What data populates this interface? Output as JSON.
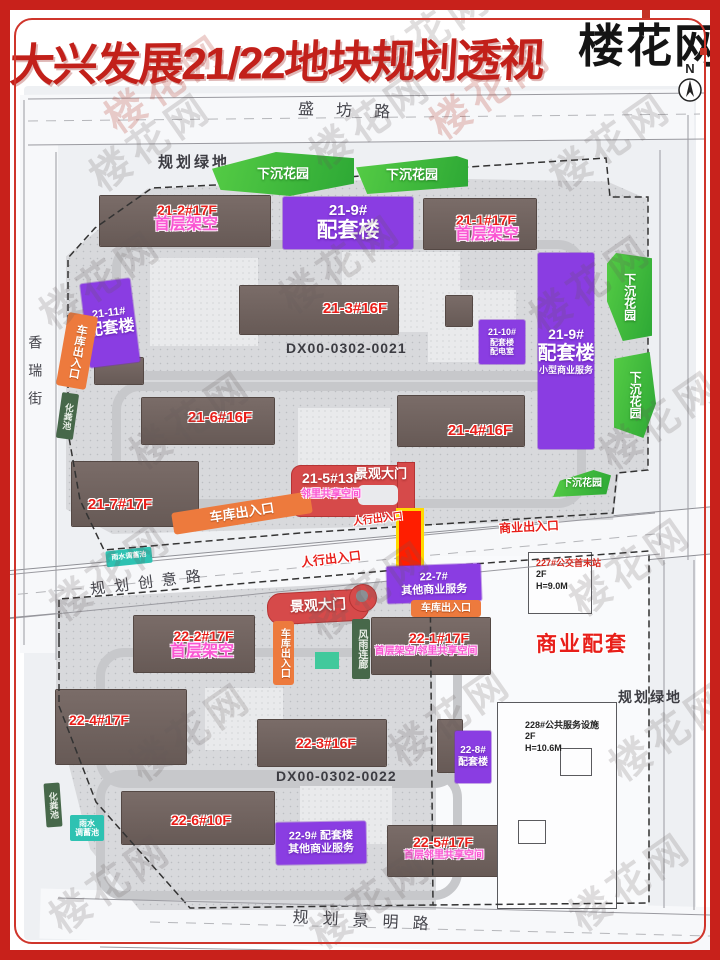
{
  "header": {
    "title": "大兴发展21/22地块规划透视",
    "logo": "楼花网",
    "compass": "N"
  },
  "watermark": {
    "text": "楼花网"
  },
  "map": {
    "parcel_codes": [
      "DX00-0302-0021",
      "DX00-0302-0022"
    ],
    "labels": [
      {
        "name": "road-shengfang",
        "type": "road-text",
        "x": 285,
        "y": 103,
        "w": 140,
        "rot": 2,
        "ls": 22,
        "lines": [
          {
            "t": "盛坊路",
            "fs": 16
          }
        ]
      },
      {
        "name": "road-xiangrui",
        "type": "road-text",
        "x": 26,
        "y": 332,
        "w": 18,
        "h": 90,
        "vert": true,
        "ls": 14,
        "lines": [
          {
            "t": "香瑞街",
            "fs": 14
          }
        ]
      },
      {
        "name": "road-chuangyi",
        "type": "road-text",
        "x": 90,
        "y": 574,
        "w": 120,
        "rot": -7,
        "ls": 9,
        "lines": [
          {
            "t": "规划创意路",
            "fs": 15
          }
        ]
      },
      {
        "name": "road-jingming",
        "type": "road-text",
        "x": 280,
        "y": 913,
        "w": 175,
        "rot": 3,
        "ls": 14,
        "lines": [
          {
            "t": "规划景明路",
            "fs": 16
          }
        ]
      },
      {
        "name": "green-space-top",
        "type": "black-text",
        "x": 158,
        "y": 154,
        "ls": 3,
        "lines": [
          {
            "t": "规划绿地",
            "fs": 15
          }
        ]
      },
      {
        "name": "green-space-right",
        "type": "black-text",
        "x": 618,
        "y": 689,
        "ls": 2,
        "lines": [
          {
            "t": "规划绿地",
            "fs": 14
          }
        ]
      },
      {
        "name": "parcel-code-21",
        "type": "black-text",
        "x": 286,
        "y": 340,
        "ls": 1,
        "lines": [
          {
            "t": "DX00-0302-0021",
            "fs": 14
          }
        ]
      },
      {
        "name": "parcel-code-22",
        "type": "black-text",
        "x": 276,
        "y": 768,
        "ls": 1,
        "lines": [
          {
            "t": "DX00-0302-0022",
            "fs": 14
          }
        ]
      },
      {
        "name": "bus-terminal-note",
        "type": "note-text",
        "x": 536,
        "y": 558,
        "w": 72,
        "lines": [
          {
            "t": "227#公交首末站",
            "fs": 9,
            "cls": "red-line"
          },
          {
            "t": "2F",
            "fs": 9
          },
          {
            "t": "H=9.0M",
            "fs": 9
          }
        ]
      },
      {
        "name": "public-service-note",
        "type": "note-text",
        "x": 525,
        "y": 720,
        "w": 80,
        "lines": [
          {
            "t": "228#公共服务设施",
            "fs": 9
          },
          {
            "t": "2F",
            "fs": 9
          },
          {
            "t": "H=10.6M",
            "fs": 9
          }
        ]
      },
      {
        "name": "garden-1",
        "type": "green-box",
        "x": 212,
        "y": 152,
        "w": 142,
        "h": 44,
        "clip": "0% 38%, 45% 0%, 100% 14%, 100% 72%, 55% 100%, 6% 86%",
        "lines": [
          {
            "t": "下沉花园",
            "fs": 13
          }
        ]
      },
      {
        "name": "garden-2",
        "type": "green-box",
        "x": 356,
        "y": 156,
        "w": 112,
        "h": 38,
        "clip": "0% 30%, 90% 0%, 100% 10%, 100% 80%, 10% 100%",
        "lines": [
          {
            "t": "下沉花园",
            "fs": 13
          }
        ]
      },
      {
        "name": "garden-3",
        "type": "green-box",
        "x": 607,
        "y": 253,
        "w": 45,
        "h": 88,
        "vert": true,
        "clip": "20% 0%, 100% 6%, 100% 94%, 35% 100%, 0% 55%, 0% 12%",
        "lines": [
          {
            "t": "下沉花园",
            "fs": 12
          }
        ]
      },
      {
        "name": "garden-4",
        "type": "green-box",
        "x": 614,
        "y": 352,
        "w": 42,
        "h": 86,
        "vert": true,
        "clip": "0% 8%, 85% 0%, 100% 60%, 70% 100%, 0% 88%",
        "lines": [
          {
            "t": "下沉花园",
            "fs": 12
          }
        ]
      },
      {
        "name": "garden-5",
        "type": "green-box",
        "x": 553,
        "y": 470,
        "w": 58,
        "h": 27,
        "clip": "12% 40%, 70% 0%, 100% 20%, 92% 90%, 0% 100%",
        "lines": [
          {
            "t": "下沉花园",
            "fs": 10
          }
        ]
      },
      {
        "name": "box-21-9-top",
        "type": "purple-box",
        "x": 283,
        "y": 197,
        "w": 130,
        "h": 52,
        "lines": [
          {
            "t": "21-9#",
            "fs": 15
          },
          {
            "t": "配套楼",
            "fs": 21
          }
        ]
      },
      {
        "name": "box-21-9-right",
        "type": "purple-box",
        "x": 538,
        "y": 253,
        "w": 56,
        "h": 196,
        "lines": [
          {
            "t": "21-9#",
            "fs": 14
          },
          {
            "t": "配套楼",
            "fs": 19
          },
          {
            "t": "小型商业服务",
            "fs": 9
          }
        ]
      },
      {
        "name": "box-21-11",
        "type": "purple-box",
        "x": 85,
        "y": 281,
        "w": 50,
        "h": 84,
        "rot": -7,
        "lines": [
          {
            "t": "21-11#",
            "fs": 11
          },
          {
            "t": "配套楼",
            "fs": 16
          }
        ]
      },
      {
        "name": "box-21-10",
        "type": "purple-box",
        "x": 479,
        "y": 320,
        "w": 46,
        "h": 44,
        "lines": [
          {
            "t": "21-10#",
            "fs": 9
          },
          {
            "t": "配套楼",
            "fs": 8
          },
          {
            "t": "配电室",
            "fs": 8
          }
        ]
      },
      {
        "name": "box-22-7",
        "type": "purple-box",
        "x": 387,
        "y": 565,
        "w": 94,
        "h": 37,
        "rot": -2,
        "lines": [
          {
            "t": "22-7#",
            "fs": 11
          },
          {
            "t": "其他商业服务",
            "fs": 11
          }
        ]
      },
      {
        "name": "box-22-8",
        "type": "purple-box",
        "x": 455,
        "y": 731,
        "w": 36,
        "h": 52,
        "lines": [
          {
            "t": "22-8#",
            "fs": 10
          },
          {
            "t": "配套楼",
            "fs": 10
          }
        ]
      },
      {
        "name": "box-22-9",
        "type": "purple-box",
        "x": 276,
        "y": 822,
        "w": 90,
        "h": 42,
        "rot": -1,
        "lines": [
          {
            "t": "22-9# 配套楼",
            "fs": 11
          },
          {
            "t": "其他商业服务",
            "fs": 11
          }
        ]
      },
      {
        "name": "garage-entrance-left",
        "type": "orange-box",
        "x": 62,
        "y": 314,
        "w": 30,
        "h": 74,
        "rot": 10,
        "vert": true,
        "lines": [
          {
            "t": "车库出入口",
            "fs": 11
          }
        ]
      },
      {
        "name": "garage-entrance-mid",
        "type": "orange-box",
        "x": 172,
        "y": 502,
        "w": 140,
        "h": 22,
        "rot": -9,
        "lines": [
          {
            "t": "车库出入口",
            "fs": 13
          }
        ]
      },
      {
        "name": "garage-entrance-22-right",
        "type": "orange-box",
        "x": 411,
        "y": 600,
        "w": 70,
        "h": 17,
        "lines": [
          {
            "t": "车库出入口",
            "fs": 10
          }
        ]
      },
      {
        "name": "garage-entrance-22-vert",
        "type": "orange-box",
        "x": 273,
        "y": 621,
        "w": 21,
        "h": 64,
        "vert": true,
        "lines": [
          {
            "t": "车库出入口",
            "fs": 10
          }
        ]
      },
      {
        "name": "septic-tank-upper",
        "type": "darkgreen-box",
        "x": 59,
        "y": 393,
        "w": 17,
        "h": 46,
        "vert": true,
        "rot": 8,
        "lines": [
          {
            "t": "化粪池",
            "fs": 9
          }
        ]
      },
      {
        "name": "septic-tank-lower",
        "type": "darkgreen-box",
        "x": 45,
        "y": 783,
        "w": 16,
        "h": 44,
        "vert": true,
        "rot": -4,
        "lines": [
          {
            "t": "化粪池",
            "fs": 9
          }
        ]
      },
      {
        "name": "rain-corridor",
        "type": "darkgreen-box",
        "x": 352,
        "y": 619,
        "w": 18,
        "h": 60,
        "vert": true,
        "lines": [
          {
            "t": "风雨连廊",
            "fs": 10
          }
        ]
      },
      {
        "name": "rain-pool-upper",
        "type": "teal-box",
        "x": 106,
        "y": 549,
        "w": 46,
        "h": 16,
        "rot": -6,
        "lines": [
          {
            "t": "雨水调蓄池",
            "fs": 7
          }
        ]
      },
      {
        "name": "rain-pool-lower",
        "type": "teal-box",
        "x": 70,
        "y": 815,
        "w": 34,
        "h": 26,
        "lines": [
          {
            "t": "雨水",
            "fs": 8
          },
          {
            "t": "调蓄池",
            "fs": 8
          }
        ]
      },
      {
        "name": "label-21-2",
        "type": "red-text",
        "x": 152,
        "y": 202,
        "w": 70,
        "lines": [
          {
            "t": "21-2#17F",
            "fs": 14
          }
        ]
      },
      {
        "name": "label-21-2-note",
        "type": "pink-text",
        "x": 146,
        "y": 216,
        "w": 80,
        "lines": [
          {
            "t": "首层架空",
            "fs": 16
          }
        ]
      },
      {
        "name": "label-21-1",
        "type": "red-text",
        "x": 451,
        "y": 212,
        "w": 70,
        "lines": [
          {
            "t": "21-1#17F",
            "fs": 14
          }
        ]
      },
      {
        "name": "label-21-1-note",
        "type": "pink-text",
        "x": 448,
        "y": 226,
        "w": 78,
        "lines": [
          {
            "t": "首层架空",
            "fs": 16
          }
        ]
      },
      {
        "name": "label-21-3",
        "type": "red-text",
        "x": 315,
        "y": 300,
        "w": 80,
        "lines": [
          {
            "t": "21-3#16F",
            "fs": 15
          }
        ]
      },
      {
        "name": "label-21-6",
        "type": "red-text",
        "x": 180,
        "y": 409,
        "w": 80,
        "lines": [
          {
            "t": "21-6#16F",
            "fs": 15
          }
        ]
      },
      {
        "name": "label-21-4",
        "type": "red-text",
        "x": 440,
        "y": 422,
        "w": 80,
        "lines": [
          {
            "t": "21-4#16F",
            "fs": 15
          }
        ]
      },
      {
        "name": "label-21-7",
        "type": "red-text",
        "x": 80,
        "y": 496,
        "w": 80,
        "lines": [
          {
            "t": "21-7#17F",
            "fs": 15
          }
        ]
      },
      {
        "name": "label-21-5",
        "type": "white-text",
        "x": 297,
        "y": 470,
        "w": 70,
        "lines": [
          {
            "t": "21-5#13F",
            "fs": 14
          }
        ]
      },
      {
        "name": "label-21-5-note",
        "type": "pink-text",
        "x": 294,
        "y": 489,
        "w": 74,
        "lines": [
          {
            "t": "邻里共享空间",
            "fs": 10
          }
        ]
      },
      {
        "name": "gate-label-21",
        "type": "white-text",
        "x": 353,
        "y": 466,
        "w": 56,
        "lines": [
          {
            "t": "景观大门",
            "fs": 13
          }
        ]
      },
      {
        "name": "gate-label-22",
        "type": "white-text",
        "x": 276,
        "y": 597,
        "w": 84,
        "rot": -3,
        "lines": [
          {
            "t": "景观大门",
            "fs": 14
          }
        ]
      },
      {
        "name": "entrance-business",
        "type": "red-text",
        "x": 494,
        "y": 520,
        "w": 70,
        "rot": -3,
        "lines": [
          {
            "t": "商业出入口",
            "fs": 12
          }
        ]
      },
      {
        "name": "entrance-pedestrian-1",
        "type": "red-text",
        "x": 296,
        "y": 552,
        "w": 70,
        "rot": -7,
        "lines": [
          {
            "t": "人行出入口",
            "fs": 12
          }
        ]
      },
      {
        "name": "entrance-pedestrian-2",
        "type": "red-text",
        "x": 350,
        "y": 514,
        "w": 56,
        "rot": -7,
        "lines": [
          {
            "t": "人行出入口",
            "fs": 10
          }
        ]
      },
      {
        "name": "label-22-2",
        "type": "red-text",
        "x": 166,
        "y": 628,
        "w": 75,
        "lines": [
          {
            "t": "22-2#17F",
            "fs": 14
          }
        ]
      },
      {
        "name": "label-22-2-note",
        "type": "pink-text",
        "x": 162,
        "y": 643,
        "w": 80,
        "lines": [
          {
            "t": "首层架空",
            "fs": 16
          }
        ]
      },
      {
        "name": "label-22-1",
        "type": "red-text",
        "x": 404,
        "y": 630,
        "w": 70,
        "lines": [
          {
            "t": "22-1#17F",
            "fs": 14
          }
        ]
      },
      {
        "name": "label-22-1-note",
        "type": "pink-text",
        "x": 368,
        "y": 646,
        "w": 116,
        "lines": [
          {
            "t": "首层架空/邻里共享空间",
            "fs": 10
          }
        ]
      },
      {
        "name": "label-22-4",
        "type": "red-text",
        "x": 63,
        "y": 712,
        "w": 72,
        "lines": [
          {
            "t": "22-4#17F",
            "fs": 14
          }
        ]
      },
      {
        "name": "label-22-3",
        "type": "red-text",
        "x": 290,
        "y": 735,
        "w": 72,
        "lines": [
          {
            "t": "22-3#16F",
            "fs": 14
          }
        ]
      },
      {
        "name": "label-22-6",
        "type": "red-text",
        "x": 165,
        "y": 812,
        "w": 72,
        "lines": [
          {
            "t": "22-6#10F",
            "fs": 14
          }
        ]
      },
      {
        "name": "label-22-5",
        "type": "red-text",
        "x": 407,
        "y": 834,
        "w": 72,
        "lines": [
          {
            "t": "22-5#17F",
            "fs": 14
          }
        ]
      },
      {
        "name": "label-22-5-note",
        "type": "pink-text",
        "x": 393,
        "y": 850,
        "w": 102,
        "lines": [
          {
            "t": "首层邻里共享空间",
            "fs": 10
          }
        ]
      },
      {
        "name": "label-business-zone",
        "type": "red-text",
        "x": 530,
        "y": 633,
        "w": 104,
        "ls": 2,
        "lines": [
          {
            "t": "商业配套",
            "fs": 21
          }
        ]
      }
    ]
  }
}
